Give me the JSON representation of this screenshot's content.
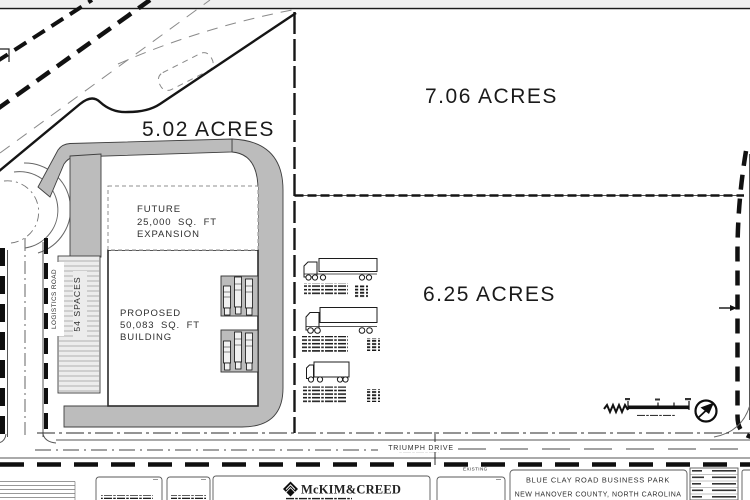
{
  "parcels": {
    "a": "5.02 ACRES",
    "b": "7.06 ACRES",
    "c": "6.25 ACRES"
  },
  "building": {
    "l1": "PROPOSED",
    "l2": "50,083 SQ. FT",
    "l3": "BUILDING"
  },
  "expansion": {
    "l1": "FUTURE",
    "l2": "25,000 SQ. FT",
    "l3": "EXPANSION"
  },
  "parking": {
    "label": "54 SPACES"
  },
  "roads": {
    "logistics": "LOGISTICS ROAD",
    "triumph": "TRIUMPH DRIVE",
    "existing": "EXISTING"
  },
  "title_block": {
    "firm": "McKIM&CREED",
    "project": "BLUE CLAY ROAD BUSINESS PARK",
    "location": "NEW HANOVER COUNTY, NORTH CAROLINA"
  },
  "vehicle_legend": {
    "items": [
      {
        "name": "tractor-semitrailer"
      },
      {
        "name": "tractor-semitrailer"
      },
      {
        "name": "single-unit-truck"
      }
    ]
  },
  "colors": {
    "pavement": "#bcbcbc",
    "linework": "#1a1a1a",
    "hatch": "#9a9a9a",
    "dashed_minor": "#808080"
  }
}
